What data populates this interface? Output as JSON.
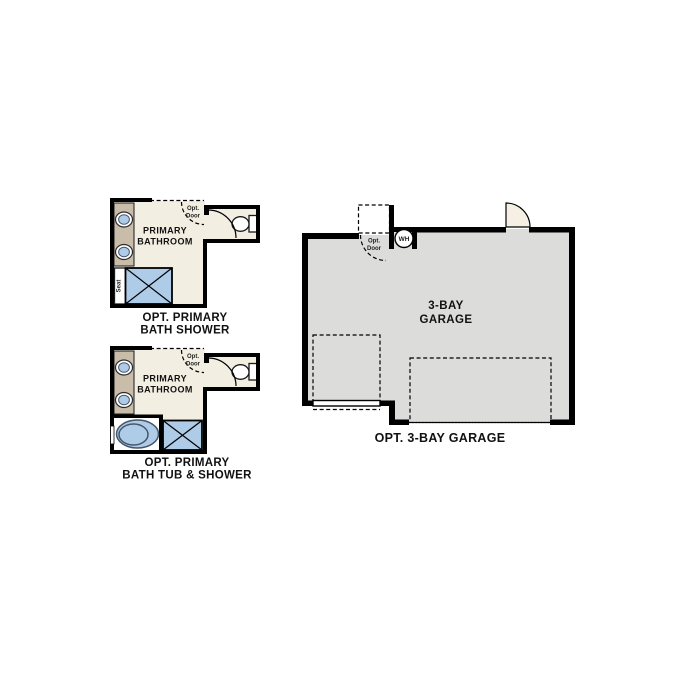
{
  "page": {
    "background": "#ffffff"
  },
  "colors": {
    "wall": "#000000",
    "bathroom_floor": "#f3eee2",
    "garage_floor": "#dcdcda",
    "counter": "#c9bca9",
    "fixture_blue": "#aecbe8",
    "fixture_outline": "#46566a",
    "door_swing_fill": "#f6efe3",
    "text": "#111111"
  },
  "figures": {
    "opt_primary_bath_shower": {
      "caption": [
        "OPT. PRIMARY",
        "BATH SHOWER"
      ],
      "room_label": [
        "PRIMARY",
        "BATHROOM"
      ],
      "seat_label": "Seat",
      "opt_door_label": [
        "Opt.",
        "Door"
      ]
    },
    "opt_primary_bath_tub_shower": {
      "caption": [
        "OPT. PRIMARY",
        "BATH TUB & SHOWER"
      ],
      "room_label": [
        "PRIMARY",
        "BATHROOM"
      ],
      "opt_door_label": [
        "Opt.",
        "Door"
      ]
    },
    "opt_3_bay_garage": {
      "caption": "OPT. 3-BAY GARAGE",
      "room_label": [
        "3-BAY",
        "GARAGE"
      ],
      "water_heater_label": "WH",
      "opt_door_label": [
        "Opt.",
        "Door"
      ]
    }
  }
}
